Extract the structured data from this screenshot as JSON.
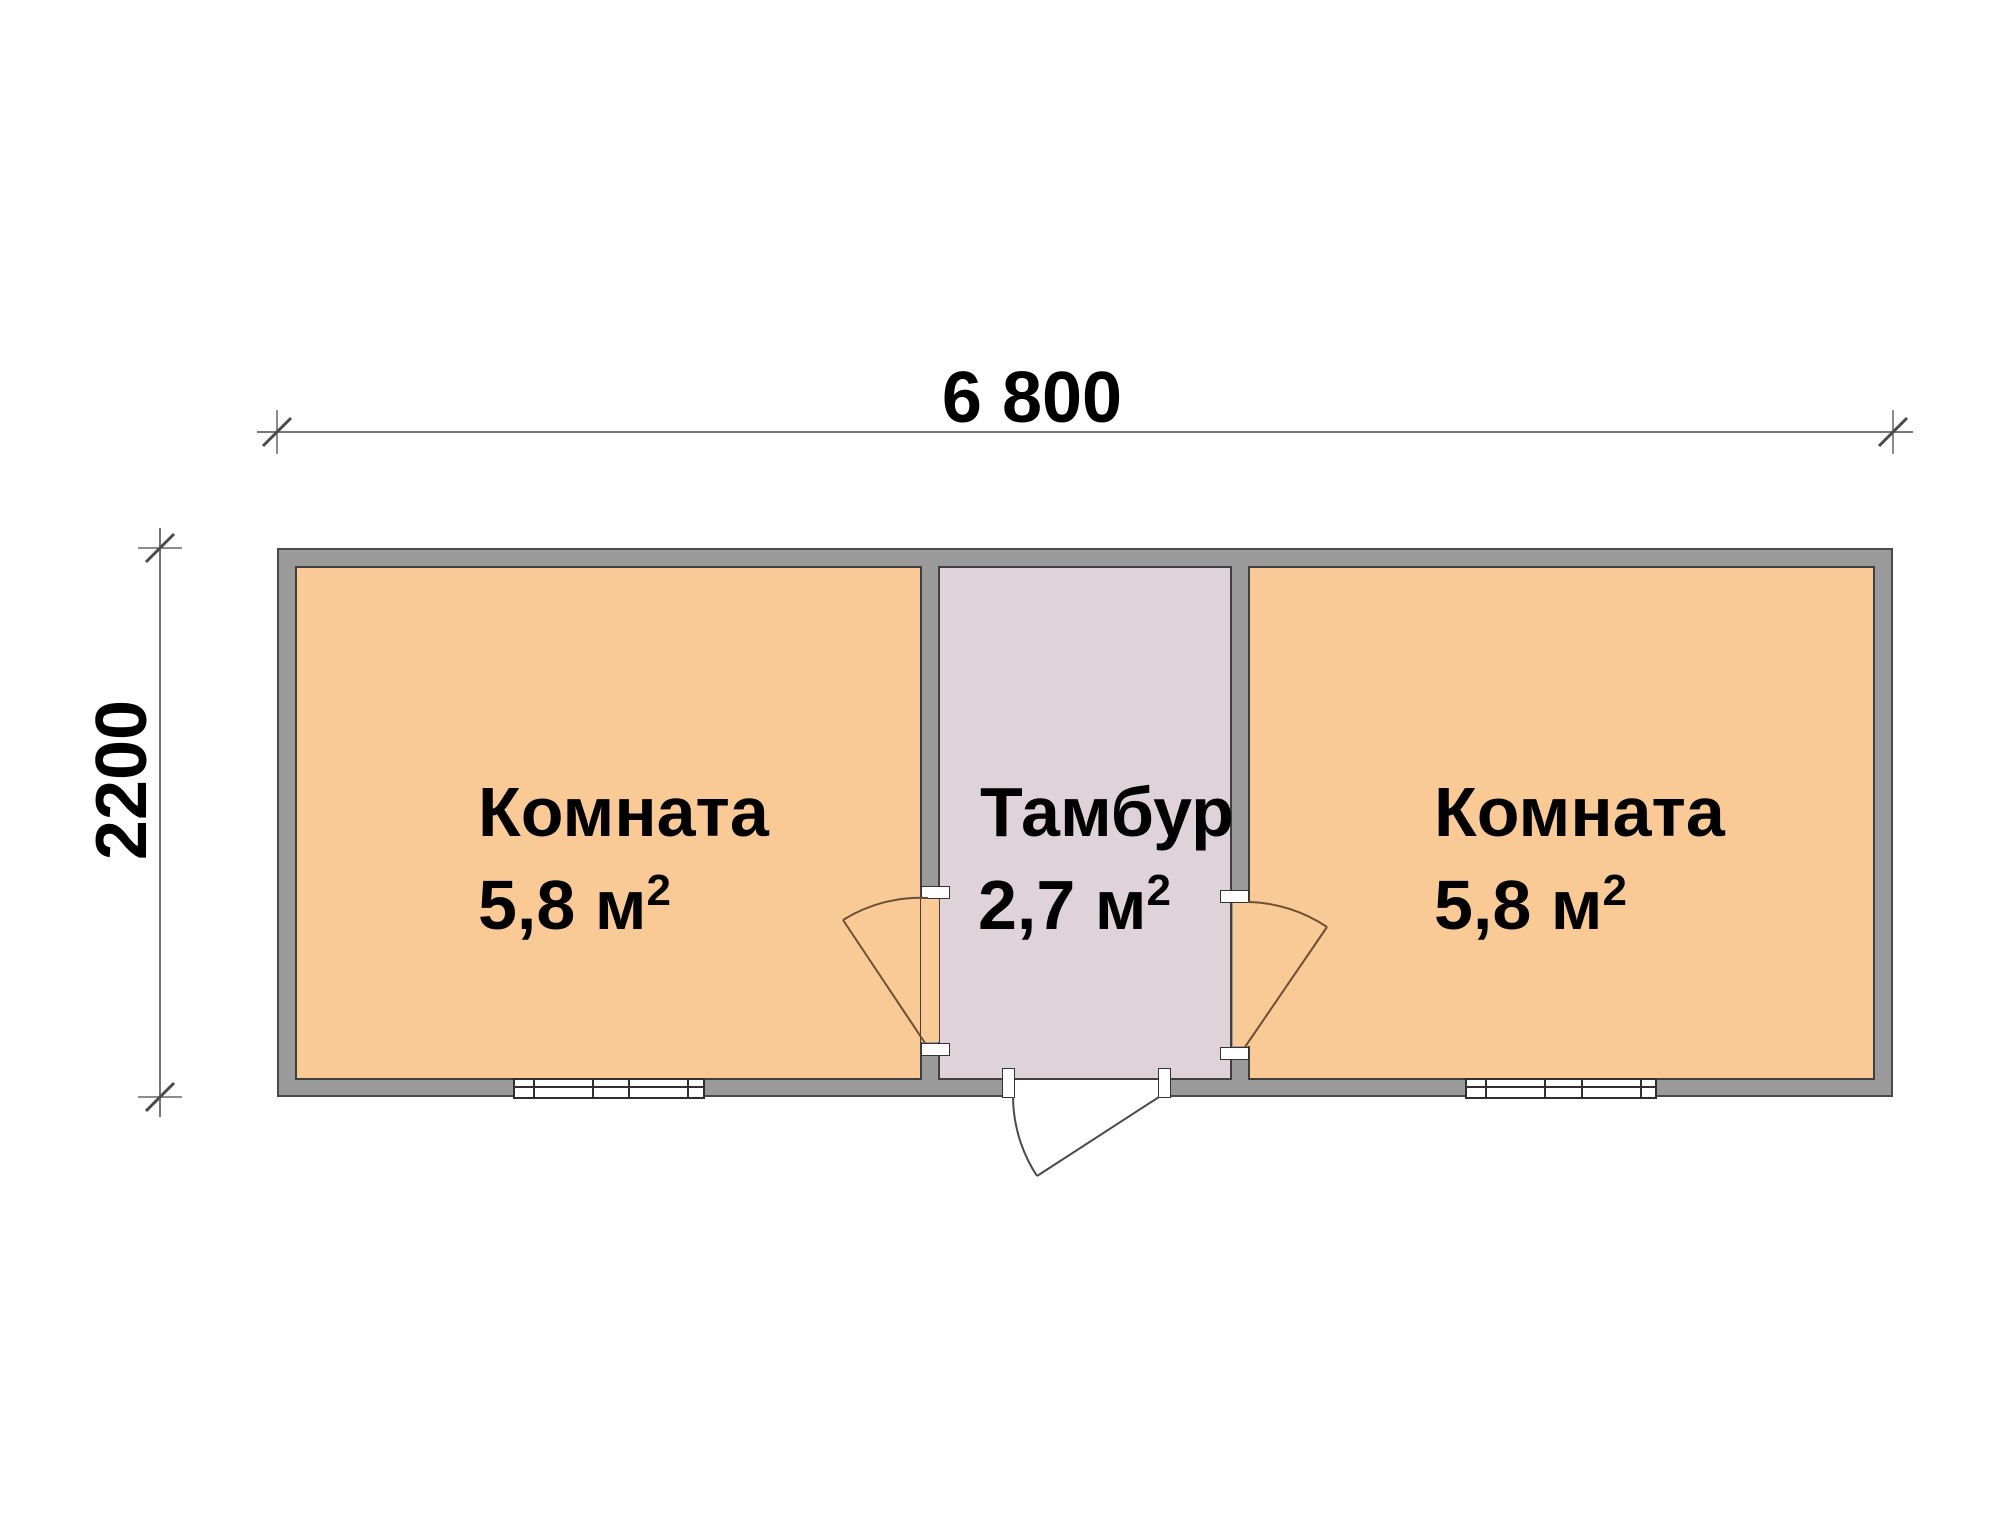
{
  "dimensions": {
    "width_label": "6 800",
    "height_label": "2200"
  },
  "rooms": [
    {
      "name": "Комната",
      "area_text": "5,8 м",
      "area_sup": "2"
    },
    {
      "name": "Тамбур",
      "area_text": "2,7 м",
      "area_sup": "2"
    },
    {
      "name": "Комната",
      "area_text": "5,8 м",
      "area_sup": "2"
    }
  ],
  "colors": {
    "room-fill": "#F9CA96",
    "vestibule-fill": "#E0D2D9",
    "wall-fill": "#9A9A9A",
    "wall-line": "#4A4A4A",
    "inner-line": "#3F3F3F",
    "dim-line": "#777777",
    "tick-line": "#4A4A4A",
    "door-line": "#6B4E36",
    "entry-door-line": "#4A4A4A",
    "text-color": "#000000",
    "background": "#FFFFFF"
  }
}
